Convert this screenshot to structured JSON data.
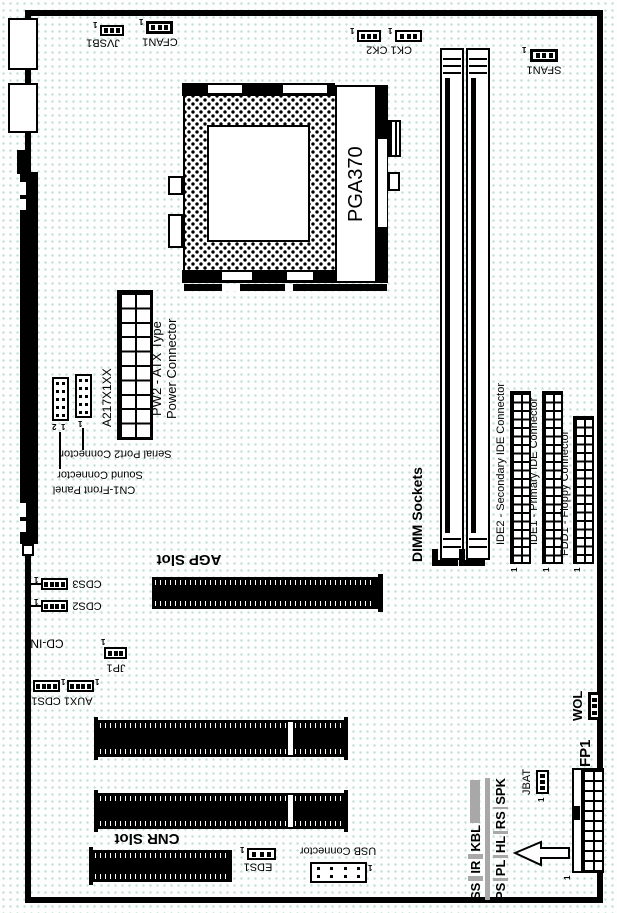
{
  "colors": {
    "ink": "#000000",
    "paper": "#fdfefd",
    "dot": "#bfe0d2",
    "gray": "#a8a8a8"
  },
  "labels": {
    "jvsb1": "JVSB1",
    "cfan1": "CFAN1",
    "ck": "CK1 CK2",
    "sfan1": "SFAN1",
    "pga370": "PGA370",
    "a217": "A217X1XX",
    "pw2_line1": "PW2 - ATX Type",
    "pw2_line2": "Power Connector",
    "serial": "Serial Port2 Connector",
    "sound": "Sound Connector",
    "cn1": "CN1-Front Panel",
    "dimm": "DIMM Sockets",
    "ide2": "IDE2 - Secondary IDE Connector",
    "ide1": "IDE1 - Primary IDE Connector",
    "fdd1": "FDD1 - Floppy Connector",
    "agp": "AGP Slot",
    "cdin": "CD-IN",
    "cds3": "CDS3",
    "cds2": "CDS2",
    "aux1cds1": "AUX1 CDS1",
    "jp1": "JP1",
    "cnr": "CNR Slot",
    "eds1": "EDS1",
    "usb": "USB Connector",
    "wol": "WOL",
    "fp1": "FP1",
    "jbat": "JBAT",
    "pin1": "1",
    "pin2": "2"
  },
  "fp_pins": {
    "row1": [
      "SS",
      "IR",
      "KBL"
    ],
    "row2": [
      "PS",
      "PL",
      "HL",
      "RS",
      "SPK"
    ]
  }
}
